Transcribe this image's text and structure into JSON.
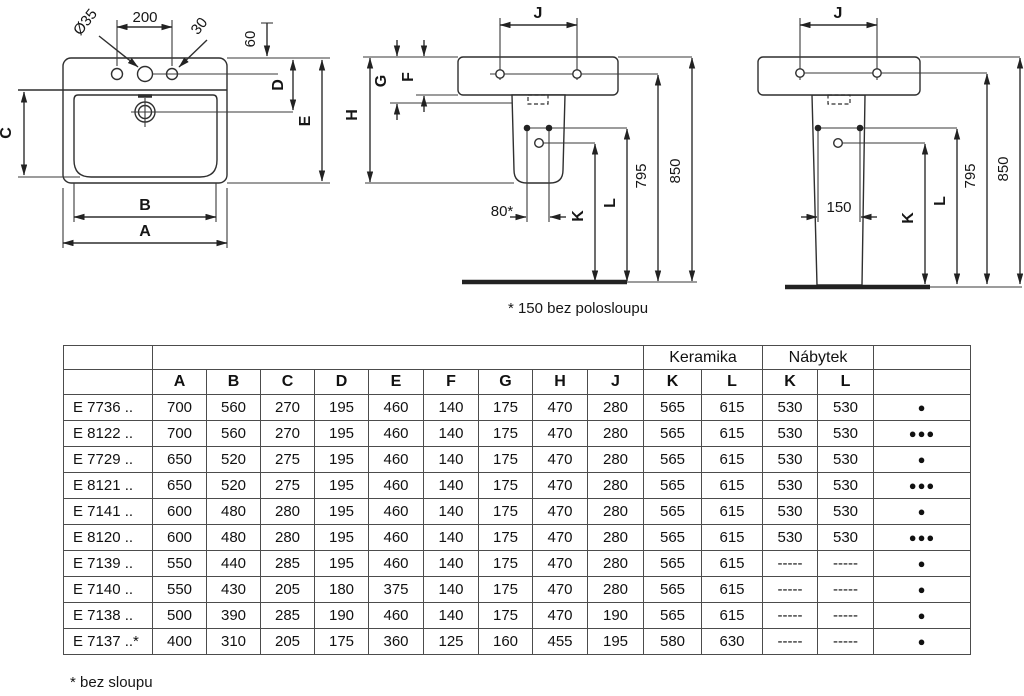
{
  "diagrams": {
    "front_view": {
      "dims": {
        "dia": "Ø35",
        "spacing": "200",
        "offset30": "30",
        "offset60": "60",
        "d": "D",
        "e": "E",
        "c": "C",
        "b": "B",
        "a": "A"
      }
    },
    "side_half_pedestal": {
      "dims": {
        "j": "J",
        "g": "G",
        "f": "F",
        "h": "H",
        "dist80": "80*",
        "k": "K",
        "l": "L",
        "h795": "795",
        "h850": "850"
      },
      "note": "* 150 bez polosloupu"
    },
    "side_full_pedestal": {
      "dims": {
        "j": "J",
        "w150": "150",
        "k": "K",
        "l": "L",
        "h795": "795",
        "h850": "850"
      }
    }
  },
  "table": {
    "group_headers": {
      "keramika": "Keramika",
      "nabytek": "Nábytek"
    },
    "columns": [
      "A",
      "B",
      "C",
      "D",
      "E",
      "F",
      "G",
      "H",
      "J",
      "K",
      "L",
      "K",
      "L"
    ],
    "rows": [
      {
        "model": "E 7736 ..",
        "values": [
          "700",
          "560",
          "270",
          "195",
          "460",
          "140",
          "175",
          "470",
          "280",
          "565",
          "615",
          "530",
          "530"
        ],
        "dots": "●"
      },
      {
        "model": "E 8122 ..",
        "values": [
          "700",
          "560",
          "270",
          "195",
          "460",
          "140",
          "175",
          "470",
          "280",
          "565",
          "615",
          "530",
          "530"
        ],
        "dots": "●●●"
      },
      {
        "model": "E 7729 ..",
        "values": [
          "650",
          "520",
          "275",
          "195",
          "460",
          "140",
          "175",
          "470",
          "280",
          "565",
          "615",
          "530",
          "530"
        ],
        "dots": "●"
      },
      {
        "model": "E 8121 ..",
        "values": [
          "650",
          "520",
          "275",
          "195",
          "460",
          "140",
          "175",
          "470",
          "280",
          "565",
          "615",
          "530",
          "530"
        ],
        "dots": "●●●"
      },
      {
        "model": "E 7141 ..",
        "values": [
          "600",
          "480",
          "280",
          "195",
          "460",
          "140",
          "175",
          "470",
          "280",
          "565",
          "615",
          "530",
          "530"
        ],
        "dots": "●"
      },
      {
        "model": "E 8120 ..",
        "values": [
          "600",
          "480",
          "280",
          "195",
          "460",
          "140",
          "175",
          "470",
          "280",
          "565",
          "615",
          "530",
          "530"
        ],
        "dots": "●●●"
      },
      {
        "model": "E 7139 ..",
        "values": [
          "550",
          "440",
          "285",
          "195",
          "460",
          "140",
          "175",
          "470",
          "280",
          "565",
          "615",
          "-----",
          "-----"
        ],
        "dots": "●"
      },
      {
        "model": "E 7140 ..",
        "values": [
          "550",
          "430",
          "205",
          "180",
          "375",
          "140",
          "175",
          "470",
          "280",
          "565",
          "615",
          "-----",
          "-----"
        ],
        "dots": "●"
      },
      {
        "model": "E 7138 ..",
        "values": [
          "500",
          "390",
          "285",
          "190",
          "460",
          "140",
          "175",
          "470",
          "190",
          "565",
          "615",
          "-----",
          "-----"
        ],
        "dots": "●"
      },
      {
        "model": "E 7137 ..*",
        "values": [
          "400",
          "310",
          "205",
          "175",
          "360",
          "125",
          "160",
          "455",
          "195",
          "580",
          "630",
          "-----",
          "-----"
        ],
        "dots": "●"
      }
    ]
  },
  "footnote": "* bez sloupu"
}
